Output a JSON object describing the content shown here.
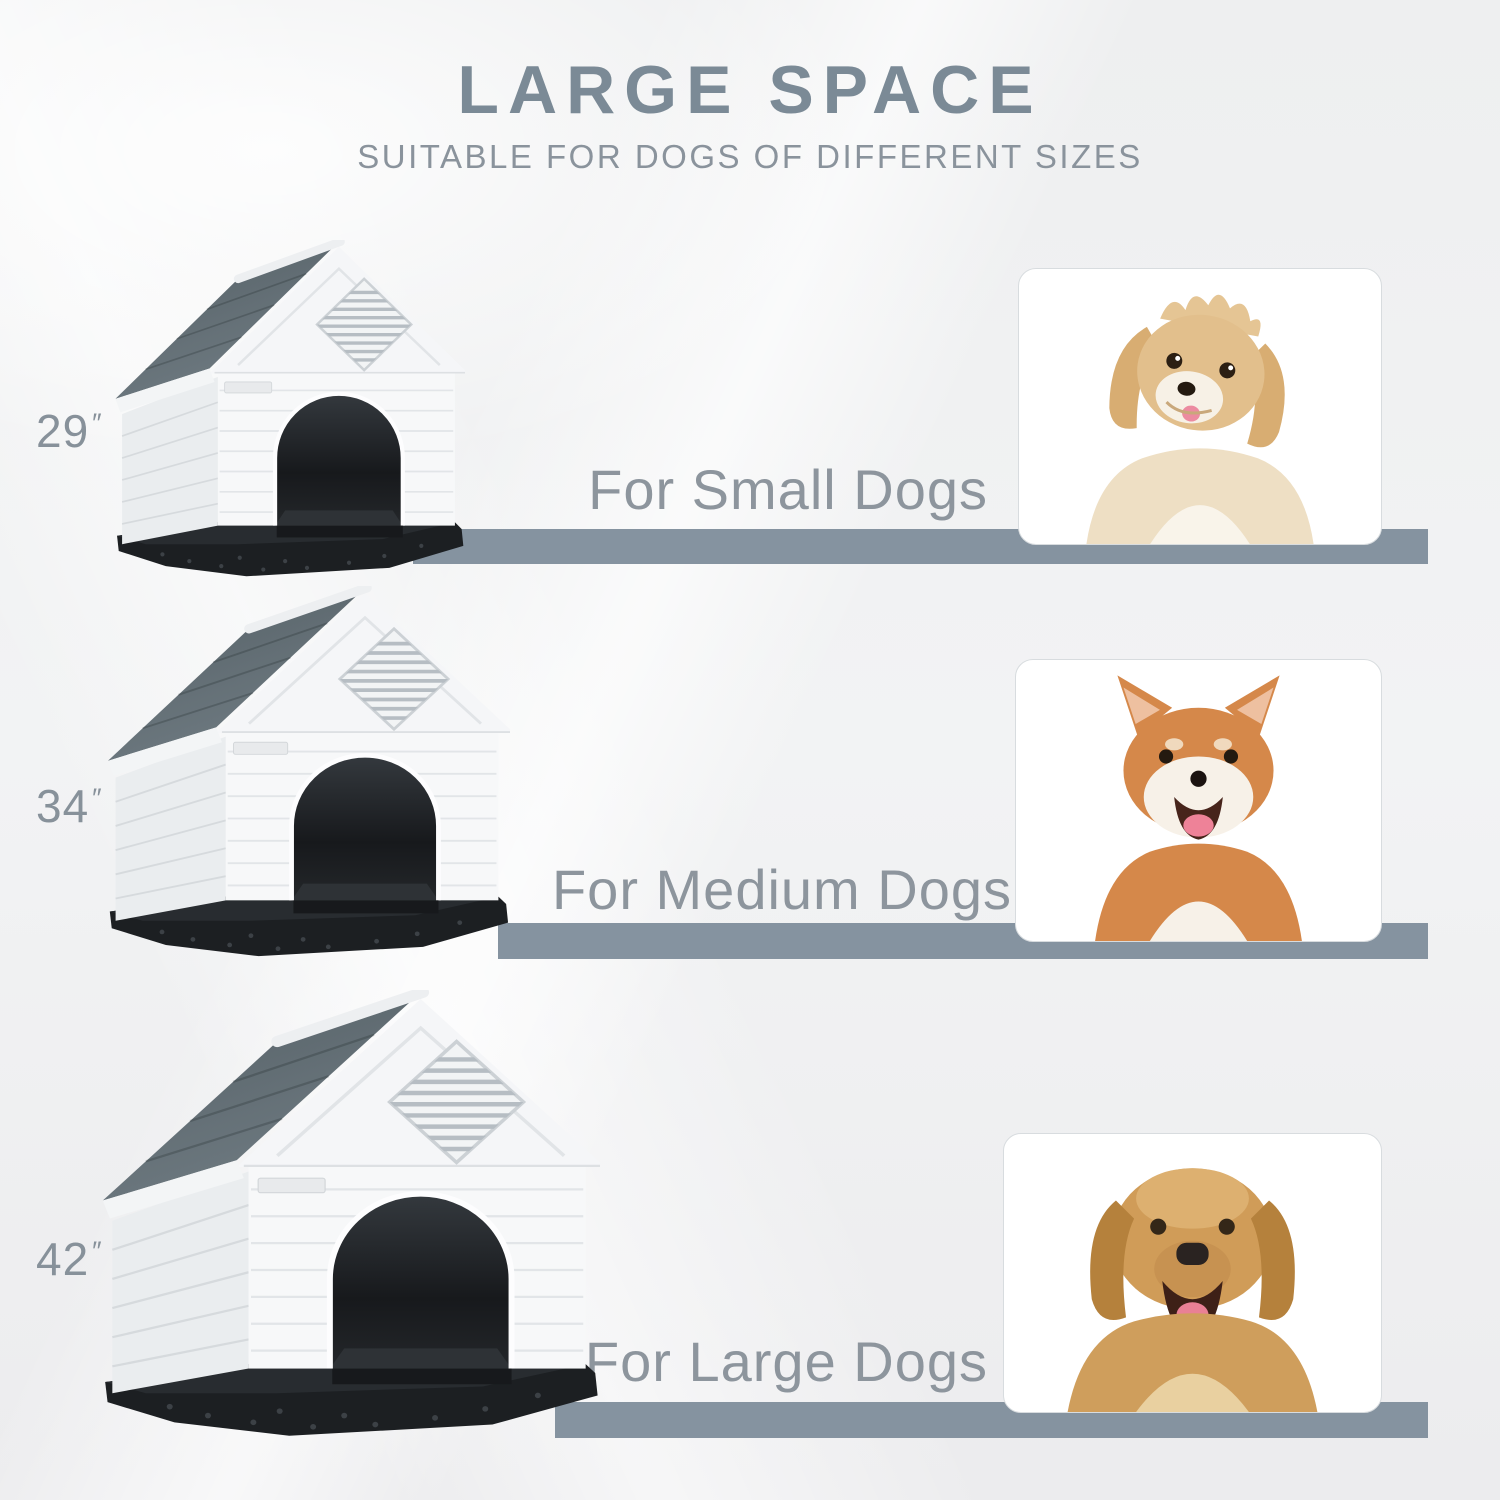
{
  "header": {
    "title": "LARGE SPACE",
    "subtitle": "SUITABLE FOR DOGS OF DIFFERENT SIZES"
  },
  "rows": [
    {
      "size_value": "29",
      "size_unit": "″",
      "audience_label": "For Small Dogs",
      "dog_icon": "small-fluffy-dog-photo",
      "house_icon": "dog-house-29in"
    },
    {
      "size_value": "34",
      "size_unit": "″",
      "audience_label": "For Medium Dogs",
      "dog_icon": "shiba-inu-photo",
      "house_icon": "dog-house-34in"
    },
    {
      "size_value": "42",
      "size_unit": "″",
      "audience_label": "For Large Dogs",
      "dog_icon": "golden-retriever-photo",
      "house_icon": "dog-house-42in"
    }
  ],
  "colors": {
    "title_text": "#7b8a96",
    "subtitle_text": "#8a939c",
    "size_label_text": "#87919a",
    "audience_text": "#8d959d",
    "shelf_bar": "#8593a0",
    "house_roof": "#5d686e",
    "house_walls": "#f6f7f8",
    "house_base": "#1c1f22",
    "card_background": "#ffffff",
    "card_border": "#d8dcdf"
  }
}
